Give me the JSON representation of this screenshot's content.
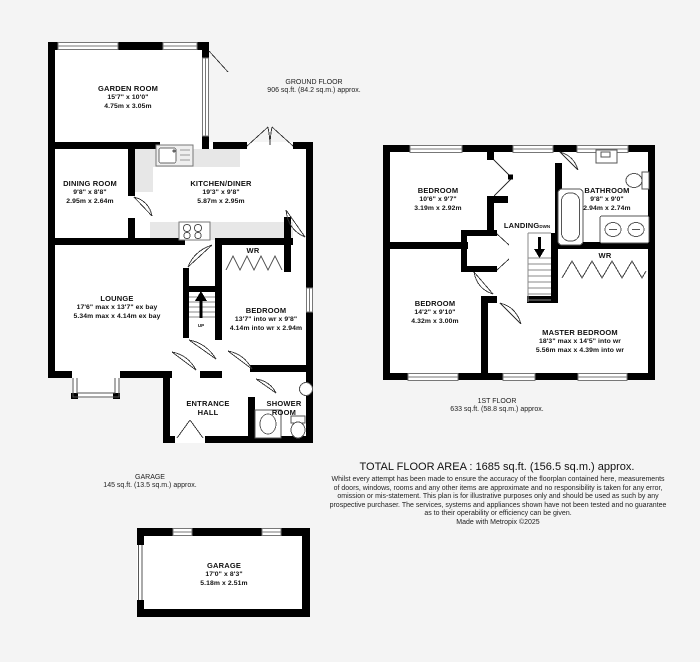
{
  "palette": {
    "background": "#f4f4f4",
    "wall": "#000000",
    "room_fill": "#ffffff",
    "counter_fill": "#e7e7e7",
    "thin_line": "#555555"
  },
  "ground": {
    "label": {
      "title": "GROUND FLOOR",
      "area": "906 sq.ft. (84.2 sq.m.) approx."
    },
    "rooms": {
      "garden_room": {
        "name": "GARDEN ROOM",
        "imperial": "15'7\" x 10'0\"",
        "metric": "4.75m x 3.05m"
      },
      "dining_room": {
        "name": "DINING ROOM",
        "imperial": "9'8\" x 8'8\"",
        "metric": "2.95m x 2.64m"
      },
      "kitchen_diner": {
        "name": "KITCHEN/DINER",
        "imperial": "19'3\" x 9'8\"",
        "metric": "5.87m x 2.95m"
      },
      "lounge": {
        "name": "LOUNGE",
        "imperial": "17'6\" max x 13'7\" ex bay",
        "metric": "5.34m max x 4.14m ex bay"
      },
      "bedroom": {
        "name": "BEDROOM",
        "imperial": "13'7\" into wr x 9'8\"",
        "metric": "4.14m into wr x 2.94m"
      },
      "wr": {
        "name": "WR"
      },
      "entrance_hall": {
        "line1": "ENTRANCE",
        "line2": "HALL"
      },
      "shower_room": {
        "line1": "SHOWER",
        "line2": "ROOM"
      }
    },
    "stair_label": "UP"
  },
  "first": {
    "label": {
      "title": "1ST FLOOR",
      "area": "633 sq.ft. (58.8 sq.m.) approx."
    },
    "rooms": {
      "bedroom1": {
        "name": "BEDROOM",
        "imperial": "10'6\" x 9'7\"",
        "metric": "3.19m x 2.92m"
      },
      "bathroom": {
        "name": "BATHROOM",
        "imperial": "9'8\" x 9'0\"",
        "metric": "2.94m x 2.74m"
      },
      "landing": {
        "name": "LANDING",
        "stair_label": "DWN"
      },
      "wr": {
        "name": "WR"
      },
      "bedroom2": {
        "name": "BEDROOM",
        "imperial": "14'2\" x 9'10\"",
        "metric": "4.32m x 3.00m"
      },
      "master_bedroom": {
        "name": "MASTER BEDROOM",
        "imperial": "18'3\" max x 14'5\" into wr",
        "metric": "5.56m max x 4.39m into wr"
      }
    }
  },
  "garage": {
    "label": {
      "title": "GARAGE",
      "area": "145 sq.ft. (13.5 sq.m.) approx."
    },
    "room": {
      "name": "GARAGE",
      "imperial": "17'0\" x 8'3\"",
      "metric": "5.18m x 2.51m"
    }
  },
  "footer": {
    "total": "TOTAL FLOOR AREA : 1685 sq.ft. (156.5 sq.m.) approx.",
    "disclaimer": [
      "Whilst every attempt has been made to ensure the accuracy of the floorplan contained here, measurements",
      "of doors, windows, rooms and any other items are approximate and no responsibility is taken for any error,",
      "omission or mis-statement. This plan is for illustrative purposes only and should be used as such by any",
      "prospective purchaser. The services, systems and appliances shown have not been tested and no guarantee",
      "as to their operability or efficiency can be given."
    ],
    "credit": "Made with Metropix ©2025"
  }
}
